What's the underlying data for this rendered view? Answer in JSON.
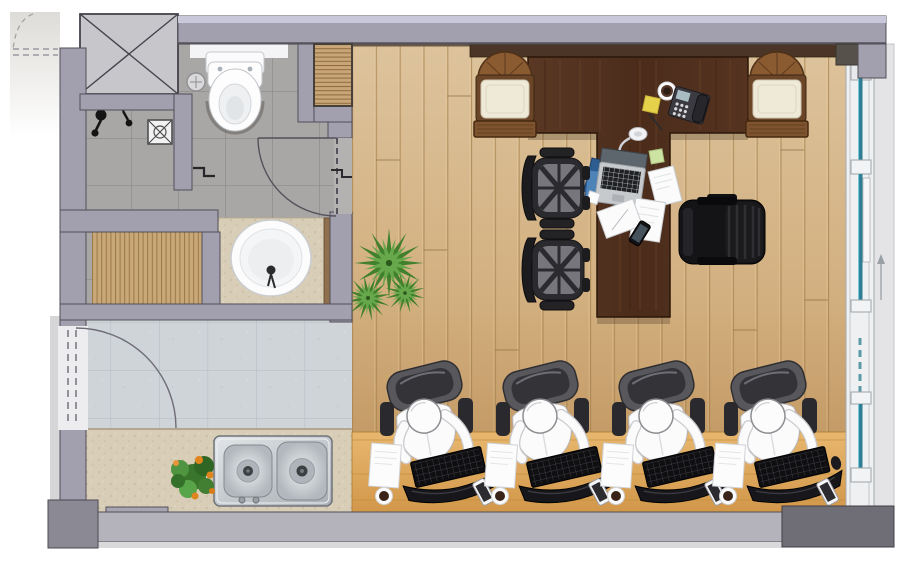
{
  "scene": {
    "kind": "architectural floor plan",
    "view": "top-down rendered color plan",
    "visible_text": "none"
  },
  "palette": {
    "wall": "#a29fae",
    "wallLight": "#c9c8db",
    "wallDark": "#6f6d76",
    "wallEdge": "#524f59",
    "tile": "#a8a7a5",
    "grout": "#918f8c",
    "entryTile": "#cfd4d8",
    "entryGrout": "#b9c0c6",
    "floorLight": "#dcc29b",
    "floorDark": "#b88d55",
    "plankLine": "#a5804c",
    "counterWood": "#e2ae64",
    "counterLine": "#b8862f",
    "deskWood": "#54341f",
    "deskGrain": "#7a4e2f",
    "stone": "#d8cdb6",
    "steel": "#c9cdd1",
    "glass": "#2a7d93",
    "paperWhite": "#fbfbfc",
    "chairDark": "#1c1c1f",
    "mesh": "#6f6f75",
    "cushion": "#efe9d8",
    "frameWood": "#6b4527",
    "leafGreen": "#4e8f35",
    "leafDark": "#2c5a1d",
    "flower": "#e0851d",
    "sticky": "#e6d14b"
  },
  "rooms": [
    {
      "id": "bathroom",
      "floor": "grey ceramic tile",
      "fixtures": [
        "elevator-shaft-crossed-box",
        "wall-hung-toilet",
        "shower-mixer-fittings",
        "floor-drain-grate",
        "step-symbol",
        "slatted-wood-deck",
        "vanity-counter-round-basin",
        "inward-swing-door"
      ]
    },
    {
      "id": "entry-hall",
      "floor": "light speckled tile",
      "fixtures": [
        "entry-swing-door",
        "kitchen-counter",
        "double-bowl-stainless-sink",
        "potted-plant-orange-flowers"
      ]
    },
    {
      "id": "office",
      "floor": "vertical wood planks",
      "fixtures": [
        "t-shaped-executive-desk",
        "guest-armchair-left",
        "guest-armchair-right",
        "task-chair-1",
        "task-chair-2",
        "black-executive-chair",
        "yucca-plant",
        "work-counter",
        "workstation-1",
        "workstation-2",
        "workstation-3",
        "workstation-4",
        "sliding-glass-window-wall"
      ]
    }
  ],
  "counts": {
    "workstations": 4,
    "task_chairs": 2,
    "guest_armchairs": 2,
    "window_glass_panels": 4
  },
  "desk_items": [
    "laptop",
    "desk-lamp",
    "blue-folders",
    "white-documents",
    "smartphone",
    "desk-phone",
    "coffee-cup",
    "yellow-sticky-note",
    "green-sticky-note",
    "pen"
  ],
  "workstation_items": [
    "mesh-office-chair",
    "seated-person",
    "keyboard",
    "mouse",
    "curved-monitor",
    "document",
    "coffee-cup",
    "smartphone"
  ],
  "window_annotation": {
    "arrow_direction": "up"
  }
}
